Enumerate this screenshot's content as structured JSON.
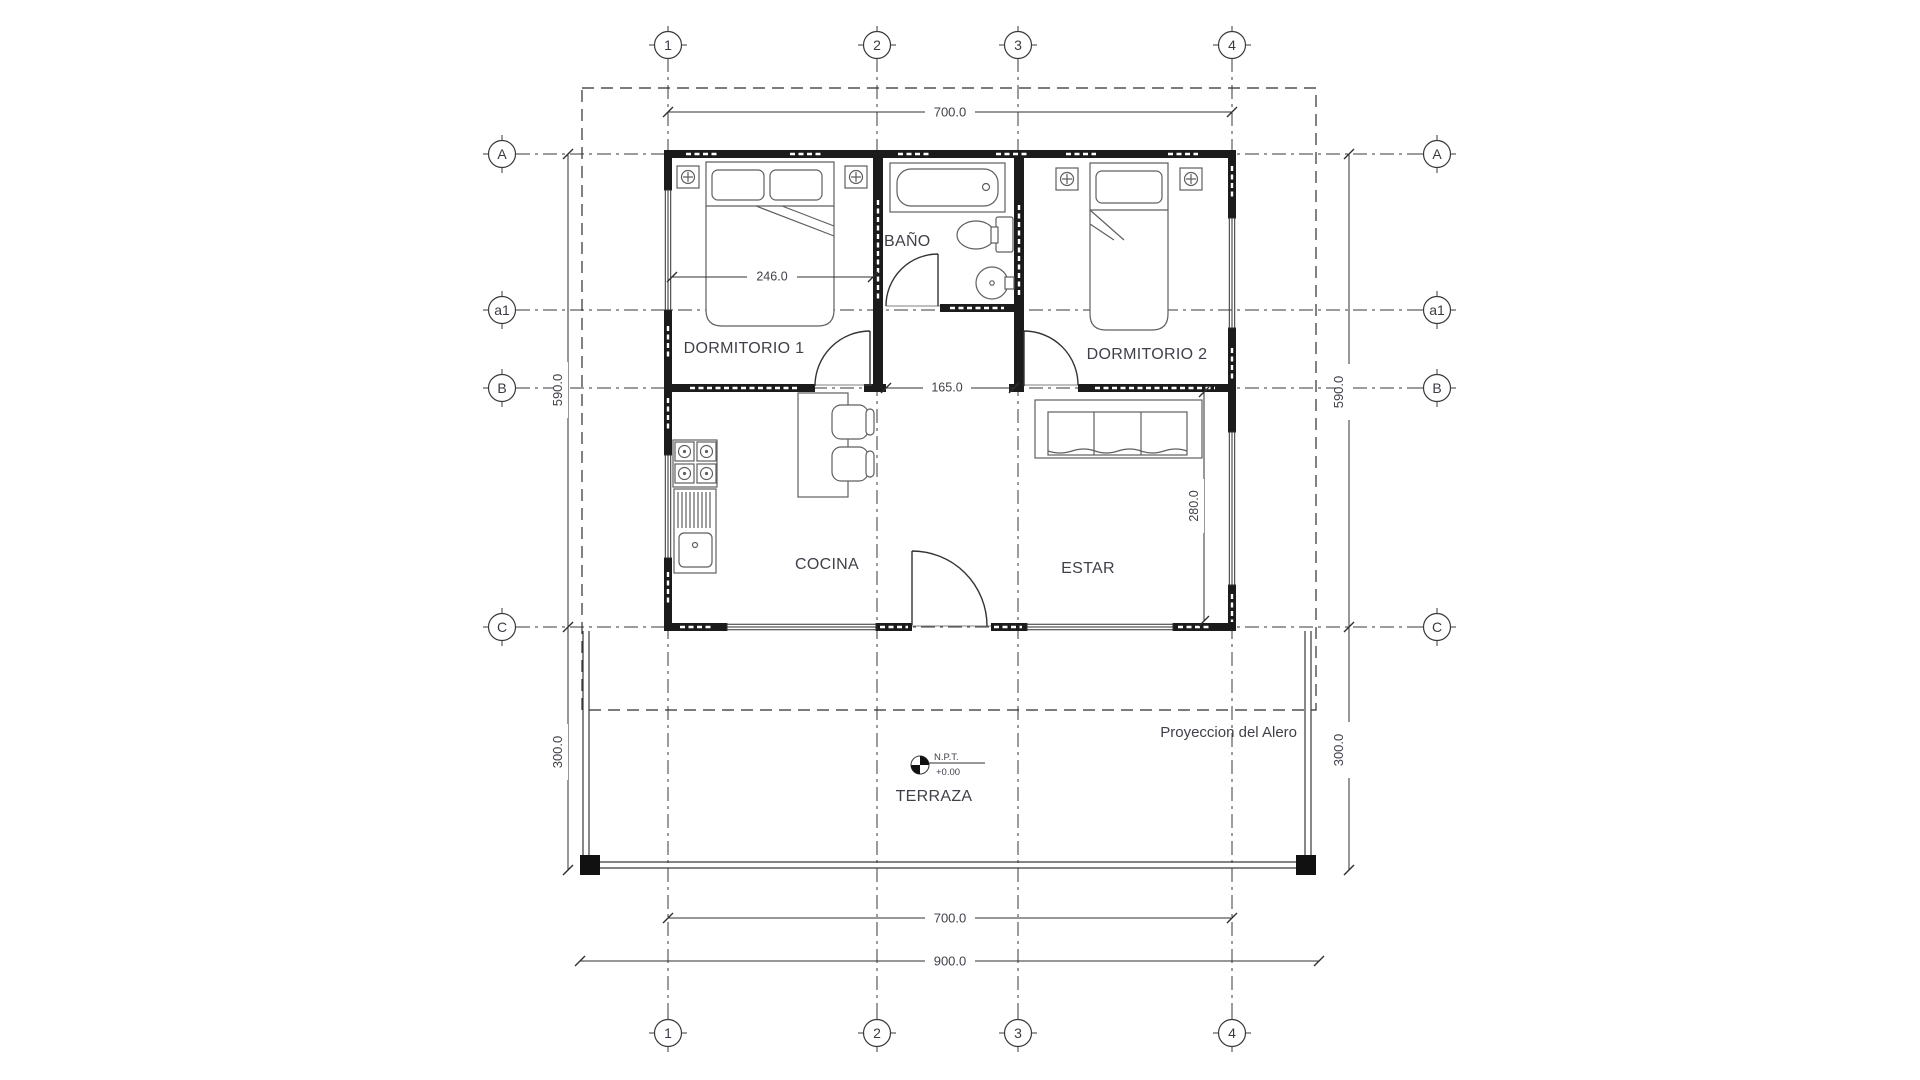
{
  "drawing": {
    "rooms": {
      "dorm1": "DORMITORIO 1",
      "bano": "BAÑO",
      "dorm2": "DORMITORIO 2",
      "cocina": "COCINA",
      "estar": "ESTAR",
      "terraza": "TERRAZA"
    },
    "dims": {
      "width_grid": "700.0",
      "width_total": "900.0",
      "height_grid": "590.0",
      "terrace_depth": "300.0",
      "dorm1_width": "246.0",
      "hall_width": "165.0",
      "estar_depth": "280.0"
    },
    "grid": {
      "cols": [
        "1",
        "2",
        "3",
        "4"
      ],
      "rows": [
        "A",
        "a1",
        "B",
        "C"
      ]
    },
    "annotations": {
      "alero": "Proyeccion del Alero",
      "npt": "N.P.T.",
      "npt_level": "+0.00"
    },
    "colors": {
      "line": "#2e2e2e",
      "wall": "#1b1b1b",
      "furniture": "#5f5f5f",
      "text": "#40404a",
      "background": "#ffffff"
    }
  }
}
